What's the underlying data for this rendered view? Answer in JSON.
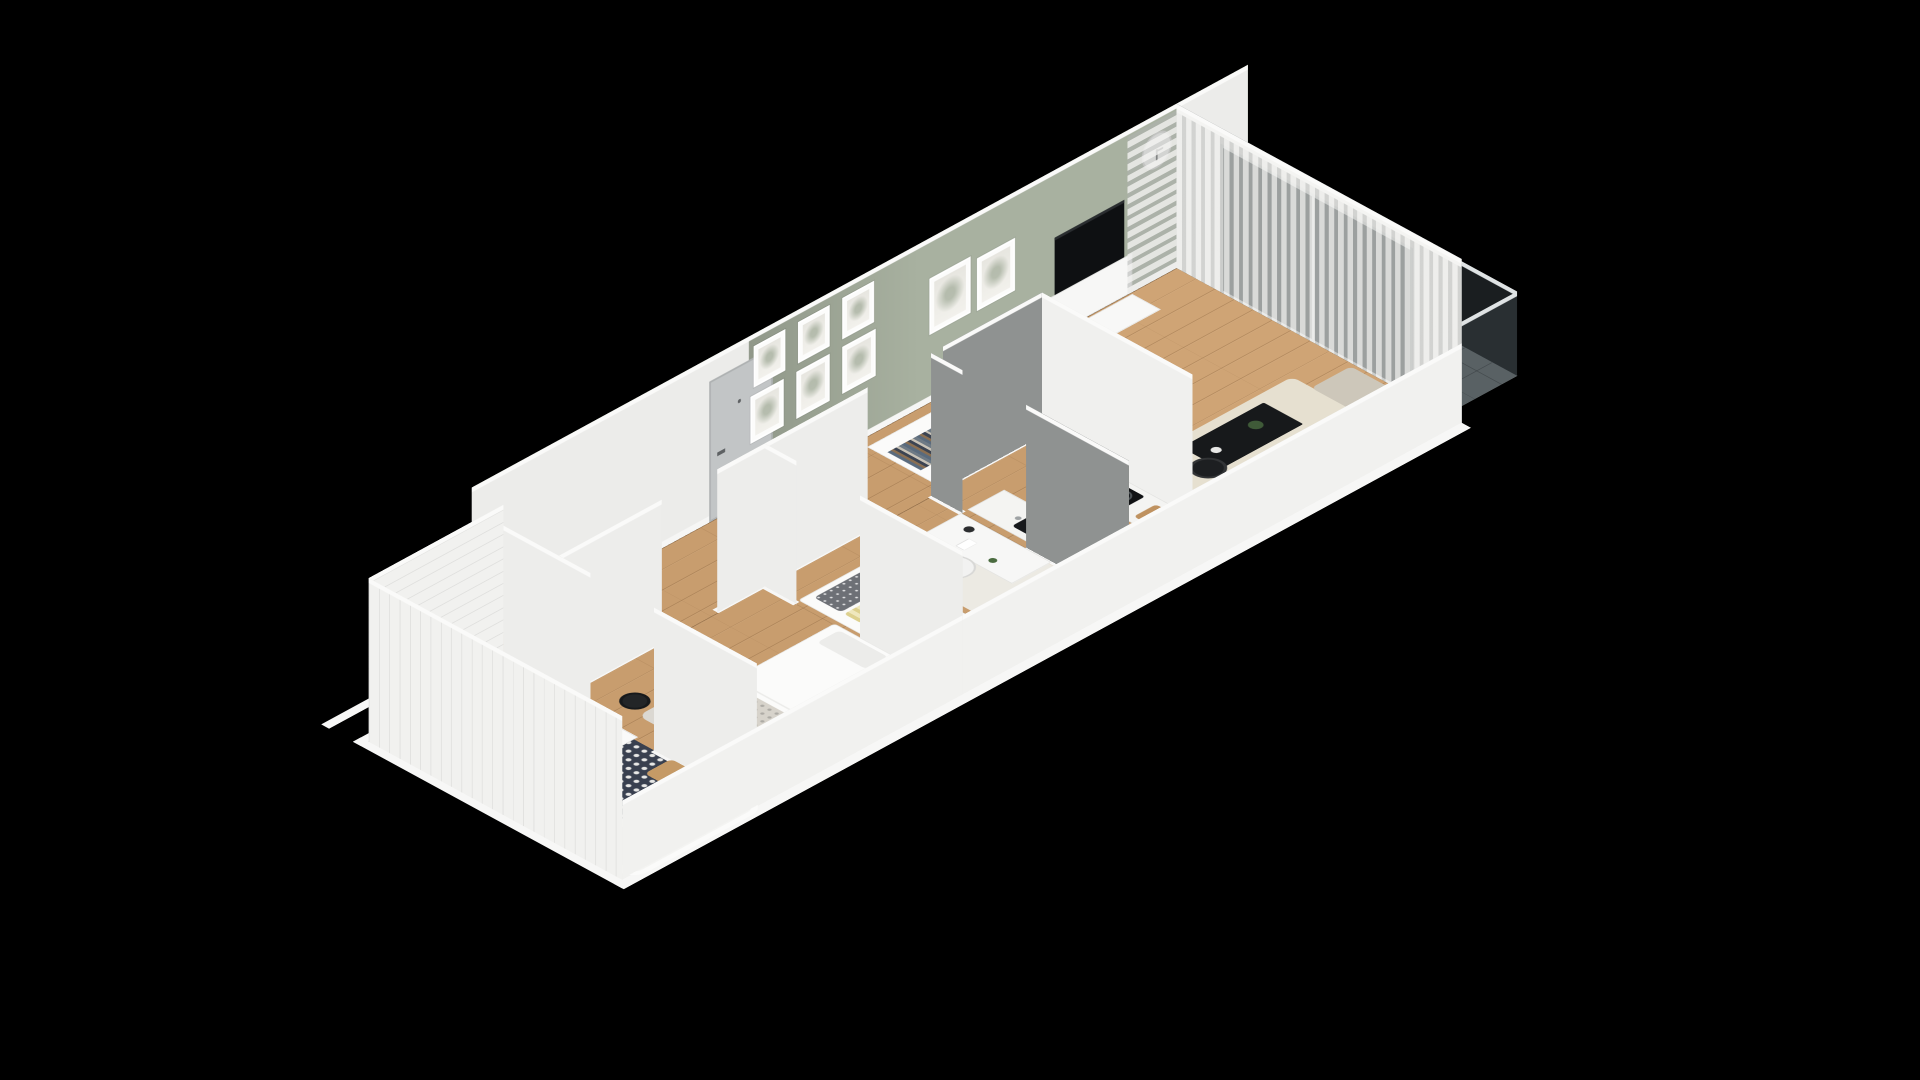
{
  "scene": {
    "type": "isometric-3d-floorplan-render",
    "background": "#000000",
    "palette": {
      "wall_white": "#ececea",
      "wall_green": "#a8b1a0",
      "wall_dark_grey": "#8f9291",
      "floor_wood": "#c89d6e",
      "bath_tile_floor": "#39404f",
      "balcony_tile": "#73797b",
      "furniture_black": "#17191b",
      "sofa_beige": "#cdc7ba",
      "rug_cream": "#e6e0d0",
      "curtain_grey": "#d8d8d6",
      "plant_green": "#4c6a42",
      "wood_accent": "#bf9260"
    },
    "rooms": [
      {
        "name": "bathroom",
        "items": [
          "bathtub",
          "wall-hung-toilet",
          "washing-machine",
          "shelf-unit-with-towels",
          "small-plant",
          "wooden-stool",
          "patterned-floor-tiles",
          "white-subway-tile-walls"
        ]
      },
      {
        "name": "main-bedroom",
        "items": [
          "double-bed-white-bedding",
          "two-pillows",
          "patterned-throw",
          "shaggy-grey-rug",
          "black-floor-planter",
          "radiator"
        ]
      },
      {
        "name": "entry-hall",
        "items": [
          "grey-entry-door",
          "gallery-wall-six-frames",
          "built-in-wardrobe-open-top-with-clothes",
          "wood-floor"
        ]
      },
      {
        "name": "second-bedroom",
        "items": [
          "single-bed",
          "polka-dot-pillow",
          "yellow-striped-pillow",
          "desk",
          "desk-lamp",
          "white-chair",
          "bird-figurine",
          "wardrobe-open-top-with-clothes",
          "white-rug",
          "radiator"
        ]
      },
      {
        "name": "kitchen",
        "items": [
          "counter-run-with-black-sink",
          "counter-run-with-cooktop",
          "two-burner-rings",
          "cutting-board",
          "tall-dark-appliance-unit",
          "wardrobe-open-top-with-clothes",
          "dark-grey-walls"
        ]
      },
      {
        "name": "living-room",
        "items": [
          "black-dining-table",
          "four-dark-chairs",
          "set-tableware-plates-vase-fruit",
          "potted-plant",
          "tv-on-green-wall",
          "white-tv-console",
          "wall-clock",
          "two-framed-prints",
          "cream-area-rug",
          "black-coffee-table",
          "black-floor-lamp",
          "beige-sofa-with-chaise",
          "sheer-grey-curtains",
          "sliding-glass-door",
          "sage-green-accent-wall"
        ]
      },
      {
        "name": "balcony",
        "items": [
          "glass-railing",
          "rattan-round-chair",
          "dark-floor-tiles"
        ]
      }
    ],
    "counts": {
      "gallery_frames": 6,
      "living_frames": 2,
      "dining_chairs": 4,
      "wardrobes": 3
    }
  }
}
